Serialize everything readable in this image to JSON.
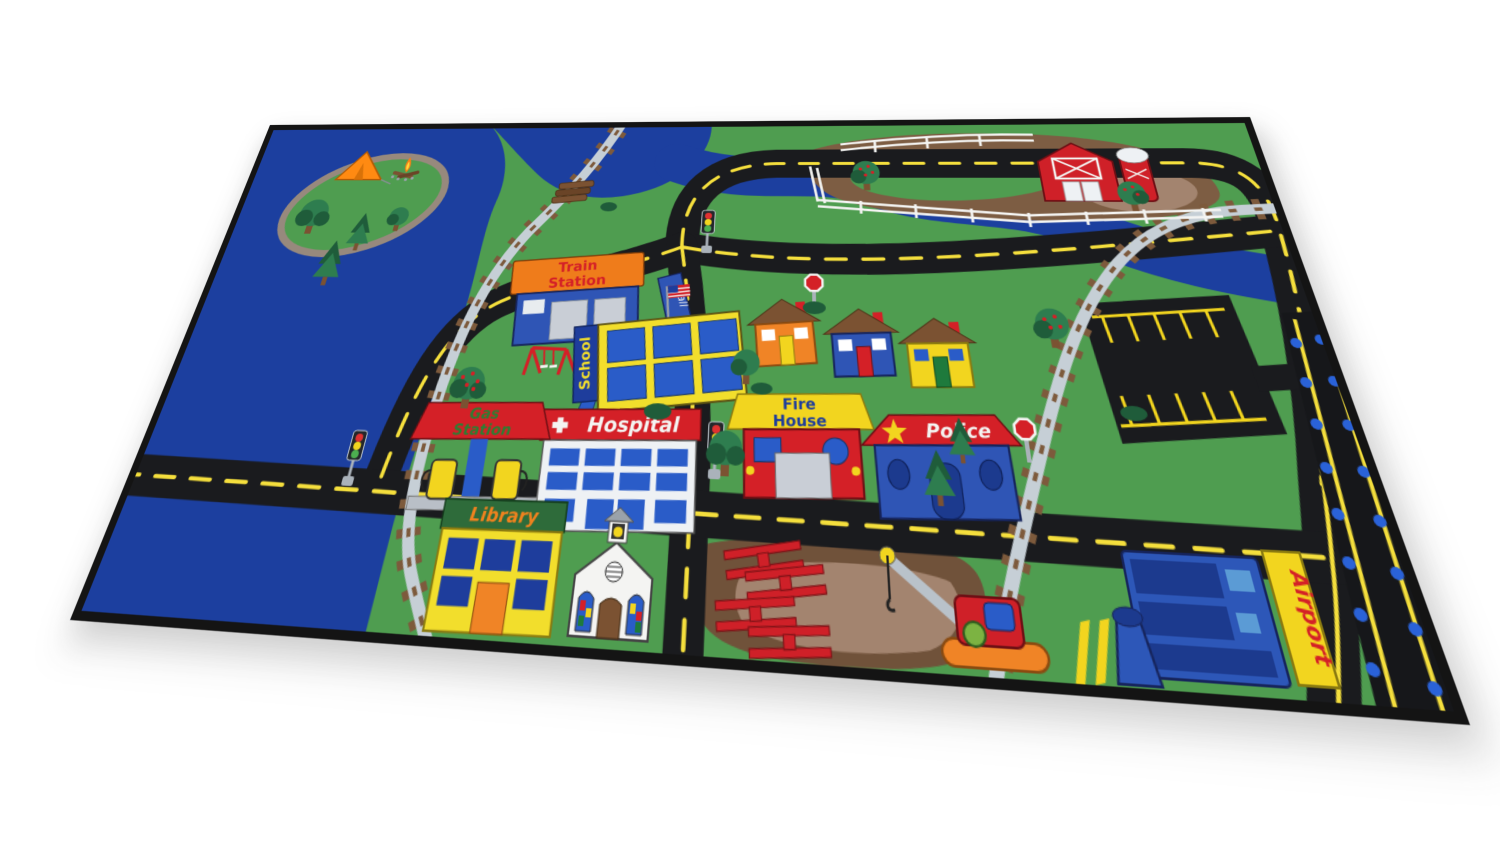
{
  "labels": {
    "train_station": {
      "line1": "Train",
      "line2": "Station"
    },
    "mall": "Mall",
    "school": "School",
    "hospital": "Hospital",
    "gas_station": {
      "line1": "Gas",
      "line2": "Station"
    },
    "fire_house": {
      "line1": "Fire",
      "line2": "House"
    },
    "police": "Police",
    "library": "Library",
    "airport": "Airport"
  },
  "palette": {
    "water": "#1c3f9f",
    "grass": "#4f9d50",
    "road": "#1a1b1e",
    "road_dash": "#f5df3d",
    "track_tie": "#7d5a3c",
    "track_rail": "#c6cfd6",
    "shore_tan": "#97897d",
    "dirt": "#7d5d43",
    "dirt_light": "#a3846f",
    "sign_red": "#d42027",
    "sign_orange": "#ef7c1b",
    "building_blue": "#2f55b5",
    "window_blue": "#2a5cc8",
    "navy": "#1e3d9c",
    "yellow": "#f2d51f",
    "barn_red": "#cf2028",
    "white": "#f4f4f2",
    "gray": "#c9ced6",
    "tree_green": "#2e7d4f",
    "tree_dark": "#1f5c3a",
    "library_green": "#2e6b3a",
    "gas_text_green": "#2e7d32",
    "runway_light_blue": "#2a62d8",
    "tent_orange": "#ff8a12",
    "crane_base_orange": "#f08426"
  }
}
